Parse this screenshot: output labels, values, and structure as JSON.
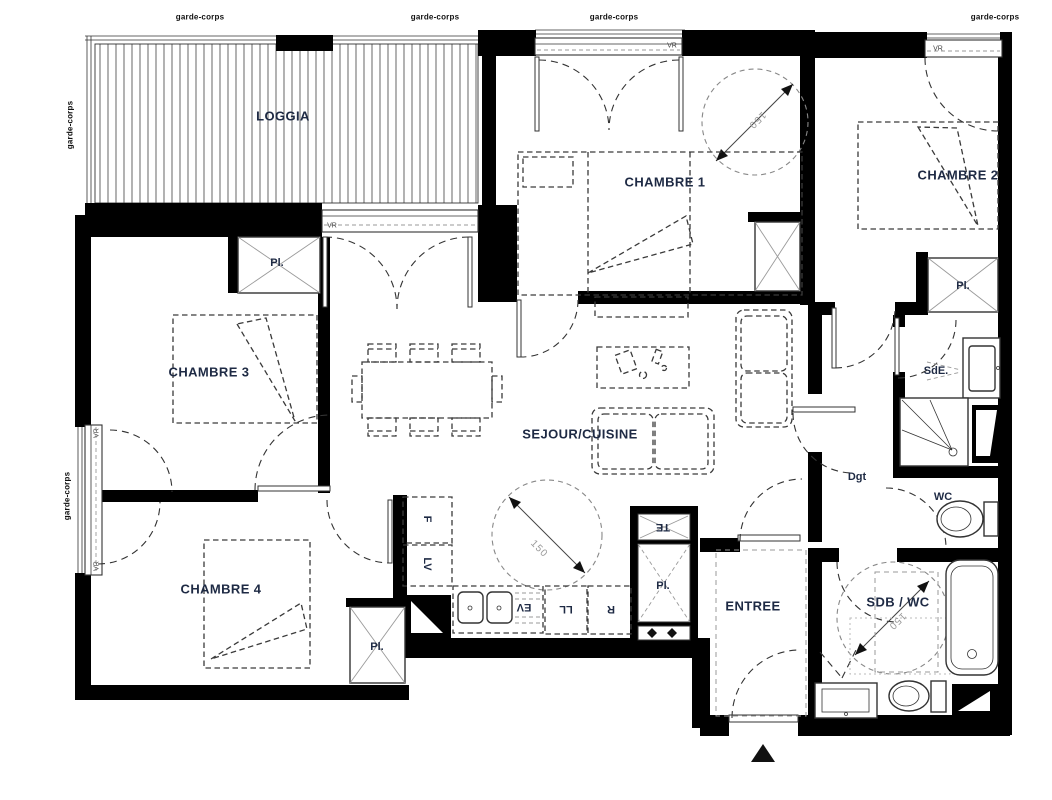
{
  "labels": {
    "rooms": {
      "loggia": "LOGGIA",
      "chambre1": "CHAMBRE 1",
      "chambre2": "CHAMBRE 2",
      "chambre3": "CHAMBRE 3",
      "chambre4": "CHAMBRE 4",
      "sejour_cuisine": "SEJOUR/CUISINE",
      "entree": "ENTREE",
      "sdb_wc": "SDB / WC",
      "sde": "SdE.",
      "wc": "WC",
      "degagement": "Dgt"
    },
    "storage": {
      "placard": "Pl."
    },
    "appliances": {
      "fridge": "F",
      "dishwasher": "LV",
      "sink": "EV",
      "washing_machine": "LL",
      "refrigerator": "R",
      "electrical_panel": "TE"
    },
    "annotations": {
      "guardrail": "garde-corps",
      "roller_shutter": "VR",
      "turning_circle": "150"
    }
  }
}
